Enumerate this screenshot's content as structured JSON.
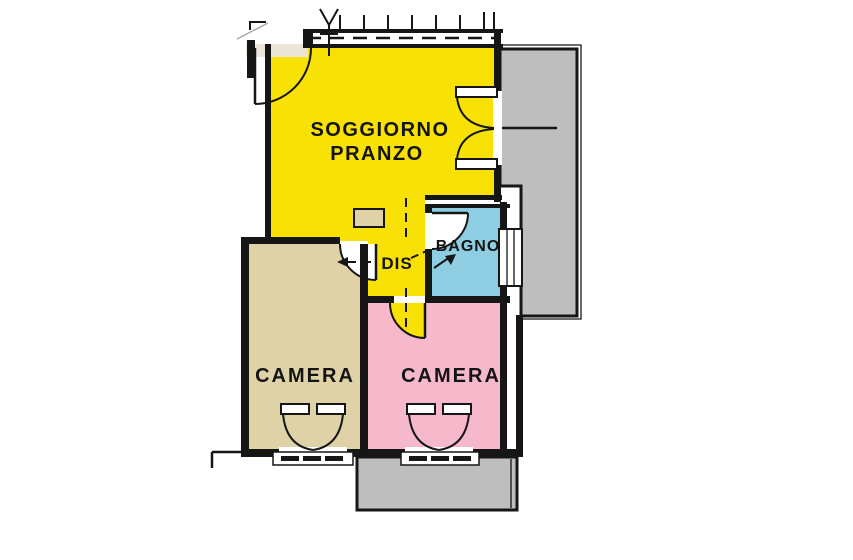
{
  "plan_title": "apartment-floor-plan",
  "rooms": {
    "soggiorno": {
      "name": "SOGGIORNO",
      "name2": "PRANZO",
      "color": "#F8E206"
    },
    "dis": {
      "name": "DIS",
      "color": "#F8E206"
    },
    "bagno": {
      "name": "BAGNO",
      "color": "#8FCEE2"
    },
    "camera_left": {
      "name": "CAMERA",
      "color": "#DFD2A6"
    },
    "camera_right": {
      "name": "CAMERA",
      "color": "#F6B9CC"
    }
  },
  "exterior": {
    "balcony_color": "#BEBEBE",
    "wall_color": "#161616",
    "background": "#FFFFFF",
    "landing_color": "#EBE6D8"
  }
}
